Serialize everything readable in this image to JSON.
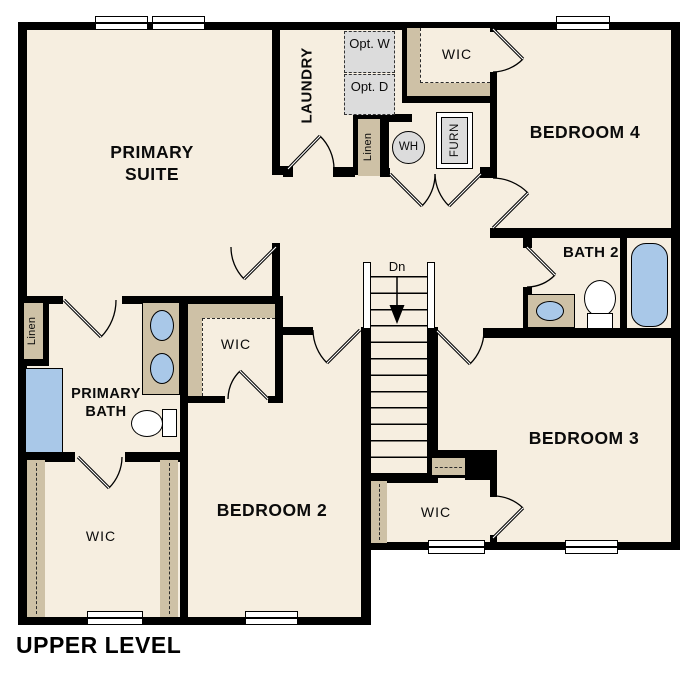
{
  "title": "UPPER LEVEL",
  "colors": {
    "floor": "#f6eee0",
    "closet_tan": "#cec1a6",
    "fixture_blue": "#a9c8e8",
    "appliance_gray": "#dcdcdc",
    "wall": "#000000",
    "background": "#ffffff"
  },
  "rooms": {
    "primary_suite": {
      "label": "PRIMARY SUITE"
    },
    "laundry": {
      "label": "LAUNDRY"
    },
    "bedroom_2": {
      "label": "BEDROOM 2"
    },
    "bedroom_3": {
      "label": "BEDROOM 3"
    },
    "bedroom_4": {
      "label": "BEDROOM 4"
    },
    "primary_bath": {
      "label": "PRIMARY BATH"
    },
    "bath_2": {
      "label": "BATH 2"
    },
    "wic_top": {
      "label": "WIC"
    },
    "wic_middle": {
      "label": "WIC"
    },
    "wic_bottom_left": {
      "label": "WIC"
    },
    "wic_bottom_middle": {
      "label": "WIC"
    }
  },
  "features": {
    "linen_hall": {
      "label": "Linen"
    },
    "linen_upper": {
      "label": "Linen"
    },
    "water_heater": {
      "label": "WH"
    },
    "furnace": {
      "label": "FURN"
    },
    "optional_washer": {
      "label": "Opt. W"
    },
    "optional_dryer": {
      "label": "Opt. D"
    },
    "stairs_down": {
      "label": "Dn"
    }
  }
}
